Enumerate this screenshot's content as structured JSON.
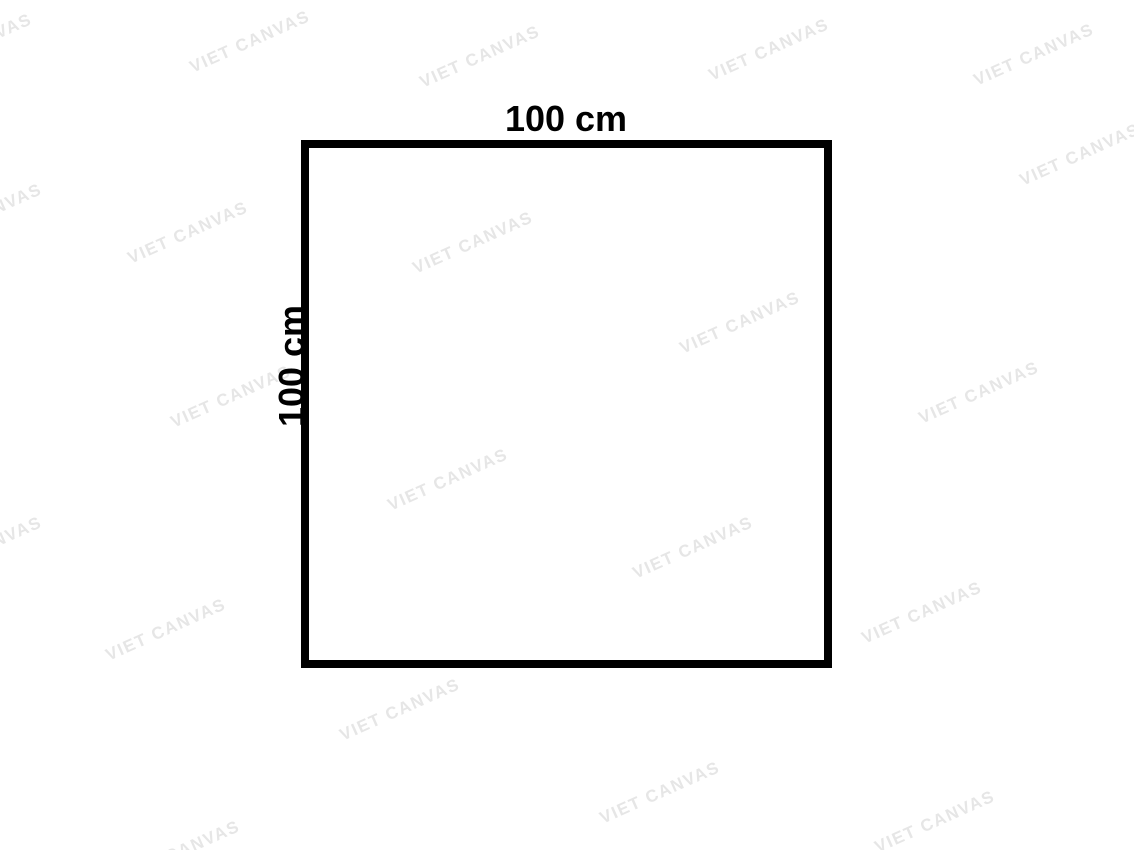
{
  "diagram": {
    "shape": "square",
    "top_label": "100 cm",
    "left_label": "100 cm",
    "border_color": "#000000",
    "background_color": "#ffffff",
    "label_color": "#000000"
  },
  "watermark": {
    "text": "VIET CANVAS",
    "color": "#e6e6e6",
    "angle_deg": -24,
    "positions": [
      {
        "x": -28,
        "y": 45
      },
      {
        "x": 250,
        "y": 42
      },
      {
        "x": 480,
        "y": 57
      },
      {
        "x": 769,
        "y": 50
      },
      {
        "x": 1034,
        "y": 55
      },
      {
        "x": -18,
        "y": 215
      },
      {
        "x": 188,
        "y": 233
      },
      {
        "x": 473,
        "y": 243
      },
      {
        "x": 1080,
        "y": 155
      },
      {
        "x": 740,
        "y": 323
      },
      {
        "x": 231,
        "y": 397
      },
      {
        "x": 979,
        "y": 393
      },
      {
        "x": 448,
        "y": 480
      },
      {
        "x": -18,
        "y": 548
      },
      {
        "x": 693,
        "y": 548
      },
      {
        "x": 166,
        "y": 630
      },
      {
        "x": 922,
        "y": 613
      },
      {
        "x": 400,
        "y": 710
      },
      {
        "x": 660,
        "y": 793
      },
      {
        "x": 935,
        "y": 822
      },
      {
        "x": 180,
        "y": 852
      }
    ]
  }
}
